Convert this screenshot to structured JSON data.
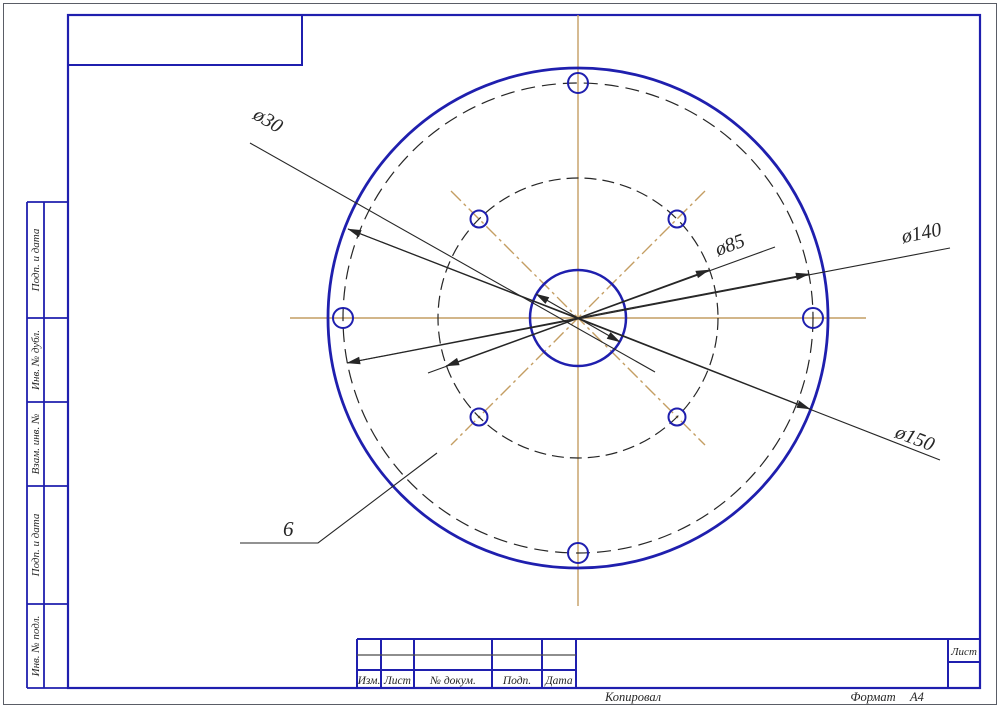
{
  "drawing": {
    "dimensions": {
      "center_hole": "ø30",
      "inner_bolt_circle": "ø85",
      "outer_bolt_circle": "ø140",
      "flange": "ø150",
      "thickness": "6"
    },
    "side_column": {
      "labels": [
        "Подп. и дата",
        "Инв. № дубл.",
        "Взам. инв. №",
        "Подп. и дата",
        "Инв. № подл."
      ]
    },
    "title_block": {
      "columns": [
        "Изм.",
        "Лист",
        "№ докум.",
        "Подп.",
        "Дата"
      ],
      "sheet_label": "Лист"
    },
    "footer": {
      "copied_by": "Копировал",
      "format_label": "Формат",
      "format_value": "А4"
    },
    "colors": {
      "frame_blue": "#1f1fae",
      "centerline_tan": "#c49e63",
      "dimension_black": "#262626"
    }
  }
}
